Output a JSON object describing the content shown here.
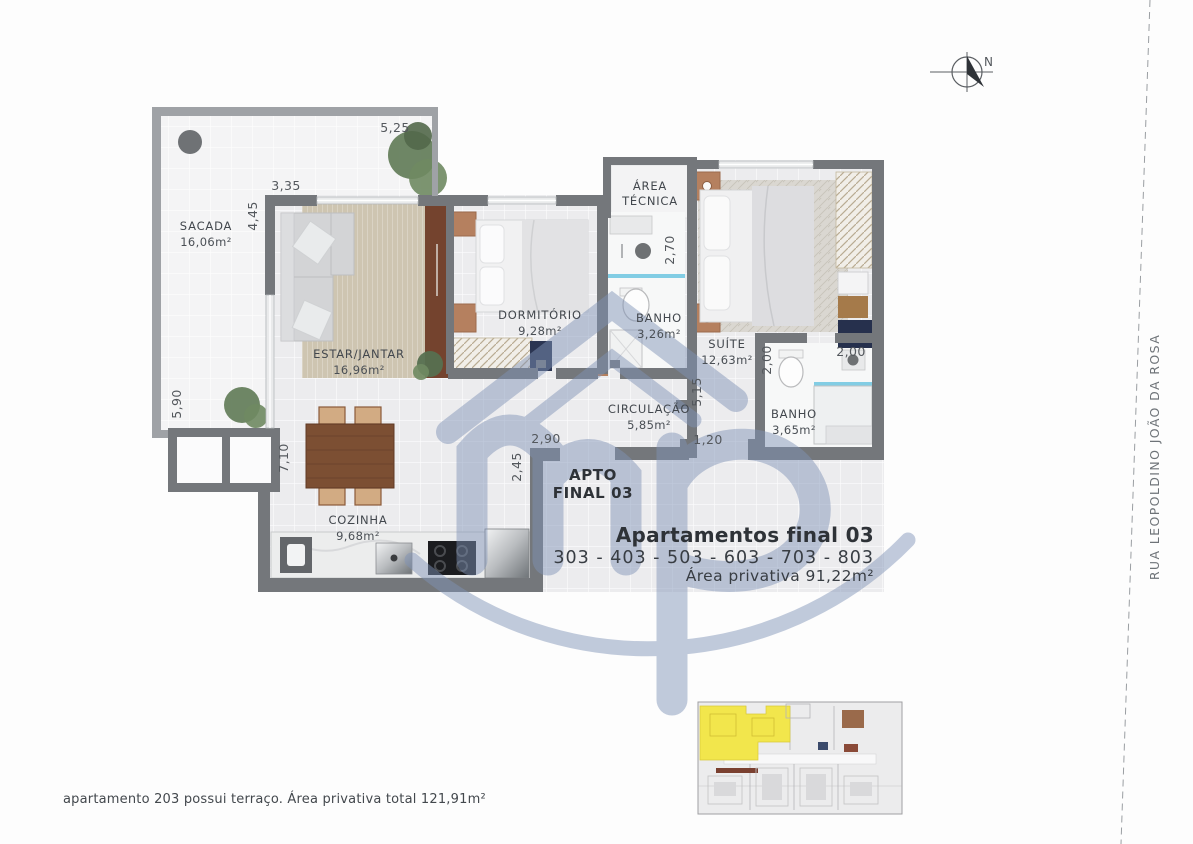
{
  "plan": {
    "rooms": [
      {
        "name": "SACADA",
        "area": "16,06m²"
      },
      {
        "name": "ESTAR/JANTAR",
        "area": "16,96m²"
      },
      {
        "name": "DORMITÓRIO",
        "area": "9,28m²"
      },
      {
        "name": "BANHO",
        "area": "3,26m²"
      },
      {
        "name": "ÁREA",
        "area": "TÉCNICA"
      },
      {
        "name": "SUÍTE",
        "area": "12,63m²"
      },
      {
        "name": "CIRCULAÇÃO",
        "area": "5,85m²"
      },
      {
        "name": "BANHO",
        "area": "3,65m²"
      },
      {
        "name": "COZINHA",
        "area": "9,68m²"
      }
    ],
    "dimensions": [
      {
        "value": "5,25"
      },
      {
        "value": "3,35"
      },
      {
        "value": "4,45"
      },
      {
        "value": "5,90"
      },
      {
        "value": "7,10"
      },
      {
        "value": "2,90"
      },
      {
        "value": "2,45"
      },
      {
        "value": "2,70"
      },
      {
        "value": "5,15"
      },
      {
        "value": "1,20"
      },
      {
        "value": "2,00"
      },
      {
        "value": "2,00"
      }
    ],
    "unit_tag": {
      "line1": "APTO",
      "line2": "FINAL 03"
    }
  },
  "title_block": {
    "title": "Apartamentos final 03",
    "units": "303 - 403 - 503 - 603 - 703 - 803",
    "area": "Área privativa 91,22m²"
  },
  "footnote": "apartamento 203 possui terraço. Área privativa total 121,91m²",
  "street_label": "RUA LEOPOLDINO JOÃO DA ROSA",
  "compass": {
    "north_label": "N"
  },
  "colors": {
    "wall": "#74777b",
    "wall_light": "#9fa2a6",
    "floor": "#ececee",
    "floor_sacada": "#f4f4f5",
    "keyplan_highlight": "#f2e64c",
    "watermark_blue": "#8093b7",
    "terracotta": "#b5805f",
    "wood": "#7c4f33",
    "navy": "#26304d",
    "shower_glass": "#82cde4"
  }
}
